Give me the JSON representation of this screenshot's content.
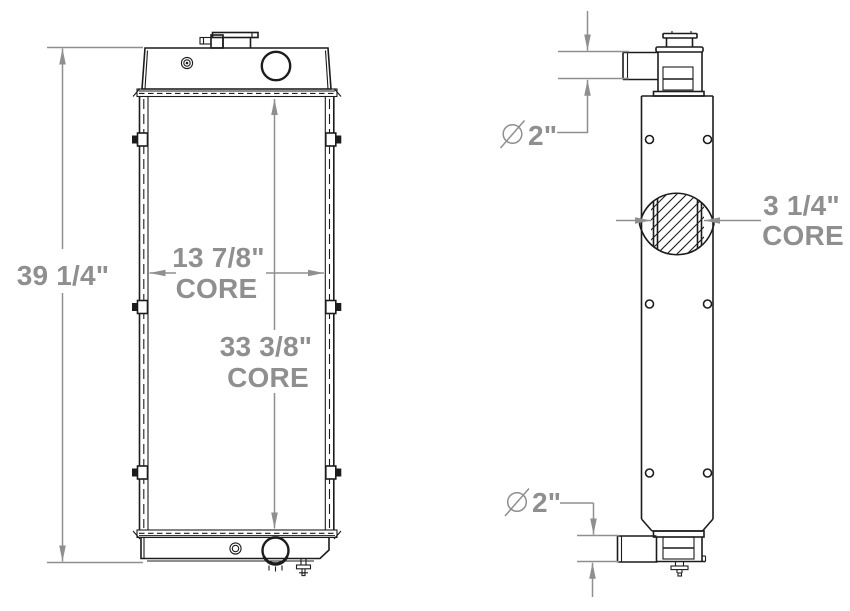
{
  "drawing": {
    "title": "radiator-dimensional-drawing",
    "colors": {
      "line": "#1c1c1c",
      "dimension": "#8f8f8f",
      "background": "#ffffff"
    },
    "front_view": {
      "overall_height": "39 1/4\"",
      "core_width": "13 7/8\"",
      "core_width_label": "CORE",
      "core_height": "33 3/8\"",
      "core_height_label": "CORE"
    },
    "side_view": {
      "diameter_symbol": "∅",
      "top_pipe_diameter": "2\"",
      "core_depth": "3 1/4\"",
      "core_depth_label": "CORE",
      "bottom_pipe_diameter": "2\""
    }
  }
}
